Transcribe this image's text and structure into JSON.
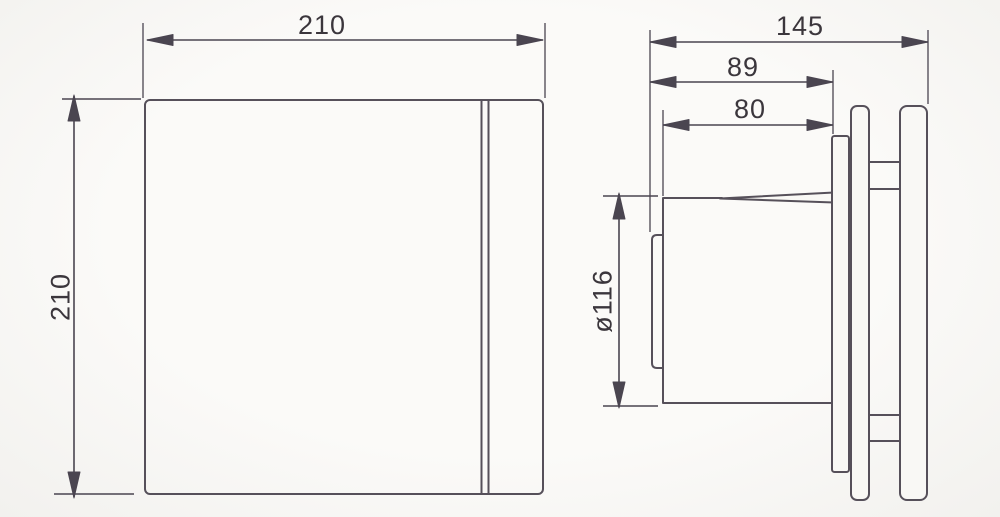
{
  "page": {
    "background_color": "#f9f8f5",
    "object_line_color": "#56505a",
    "dimension_line_color": "#4a4550",
    "text_color": "#3b363c"
  },
  "drawing": {
    "kind": "technical-dimension-drawing",
    "views": [
      "front",
      "side"
    ]
  },
  "dimensions": {
    "front_width_label": "210",
    "front_height_label": "210",
    "depth_total_label": "145",
    "depth_to_mounting_plate_label": "89",
    "duct_length_label": "80",
    "duct_diameter_label": "ø116"
  }
}
